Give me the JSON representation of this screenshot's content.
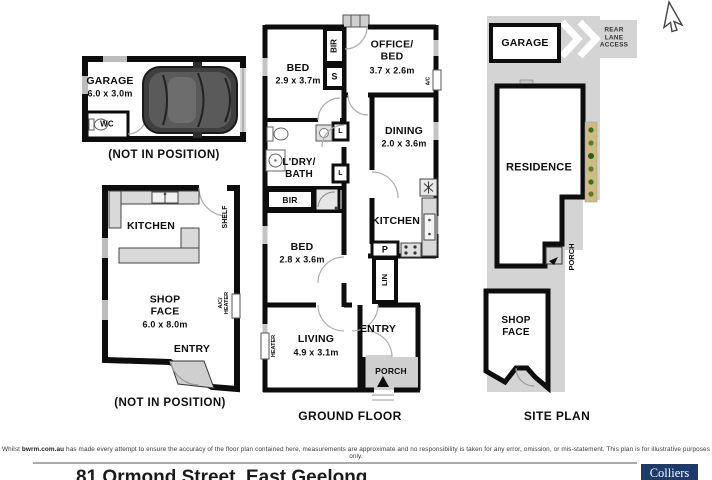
{
  "garage_unit": {
    "name": "GARAGE",
    "dims": "6.0 x 3.0m",
    "wc": "WC",
    "caption": "(NOT IN POSITION)"
  },
  "shop_unit": {
    "kitchen": "KITCHEN",
    "shelf": "SHELF",
    "name": "SHOP\nFACE",
    "dims": "6.0 x 8.0m",
    "ac_heater": "A/C/\nHEATER",
    "entry": "ENTRY",
    "caption": "(NOT IN POSITION)"
  },
  "ground_floor": {
    "caption": "GROUND FLOOR",
    "bed1": {
      "name": "BED",
      "dims": "2.9 x 3.7m"
    },
    "office": {
      "name": "OFFICE/\nBED",
      "dims": "3.7 x 2.6m"
    },
    "dining": {
      "name": "DINING",
      "dims": "2.0 x 3.6m"
    },
    "ldry_bath": {
      "name": "L'DRY/\nBATH"
    },
    "bed2": {
      "name": "BED",
      "dims": "2.8 x 3.6m"
    },
    "kitchen": {
      "name": "KITCHEN"
    },
    "living": {
      "name": "LIVING",
      "dims": "4.9 x 3.1m"
    },
    "entry": "ENTRY",
    "porch": "PORCH",
    "closets": {
      "bir1": "BIR",
      "s": "S",
      "bir2": "BIR",
      "linen1": "L",
      "linen2": "L",
      "lin": "LIN",
      "pantry": "P"
    },
    "fixtures": {
      "heater": "HEATER",
      "ac": "A/C"
    }
  },
  "site_plan": {
    "caption": "SITE PLAN",
    "garage": "GARAGE",
    "rear_lane": "REAR\nLANE\nACCESS",
    "residence": "RESIDENCE",
    "porch": "PORCH",
    "shop": "SHOP\nFACE"
  },
  "footer": {
    "disclaimer_pre": "Whilst ",
    "disclaimer_brand": "bwrm.com.au",
    "disclaimer_post": " has made every attempt to ensure the accuracy of the floor plan contained here, measurements are approximate and no responsibility is taken for any error, omission, or mis-statement. This plan is for illustrative purposes only.",
    "address": "81 Ormond Street, East Geelong",
    "logo": "Colliers"
  },
  "colors": {
    "wall": "#0d0d0d",
    "site_gray": "#d4d4d4",
    "logo_navy": "#1d3a6d",
    "greenery": "#cdbd85"
  }
}
